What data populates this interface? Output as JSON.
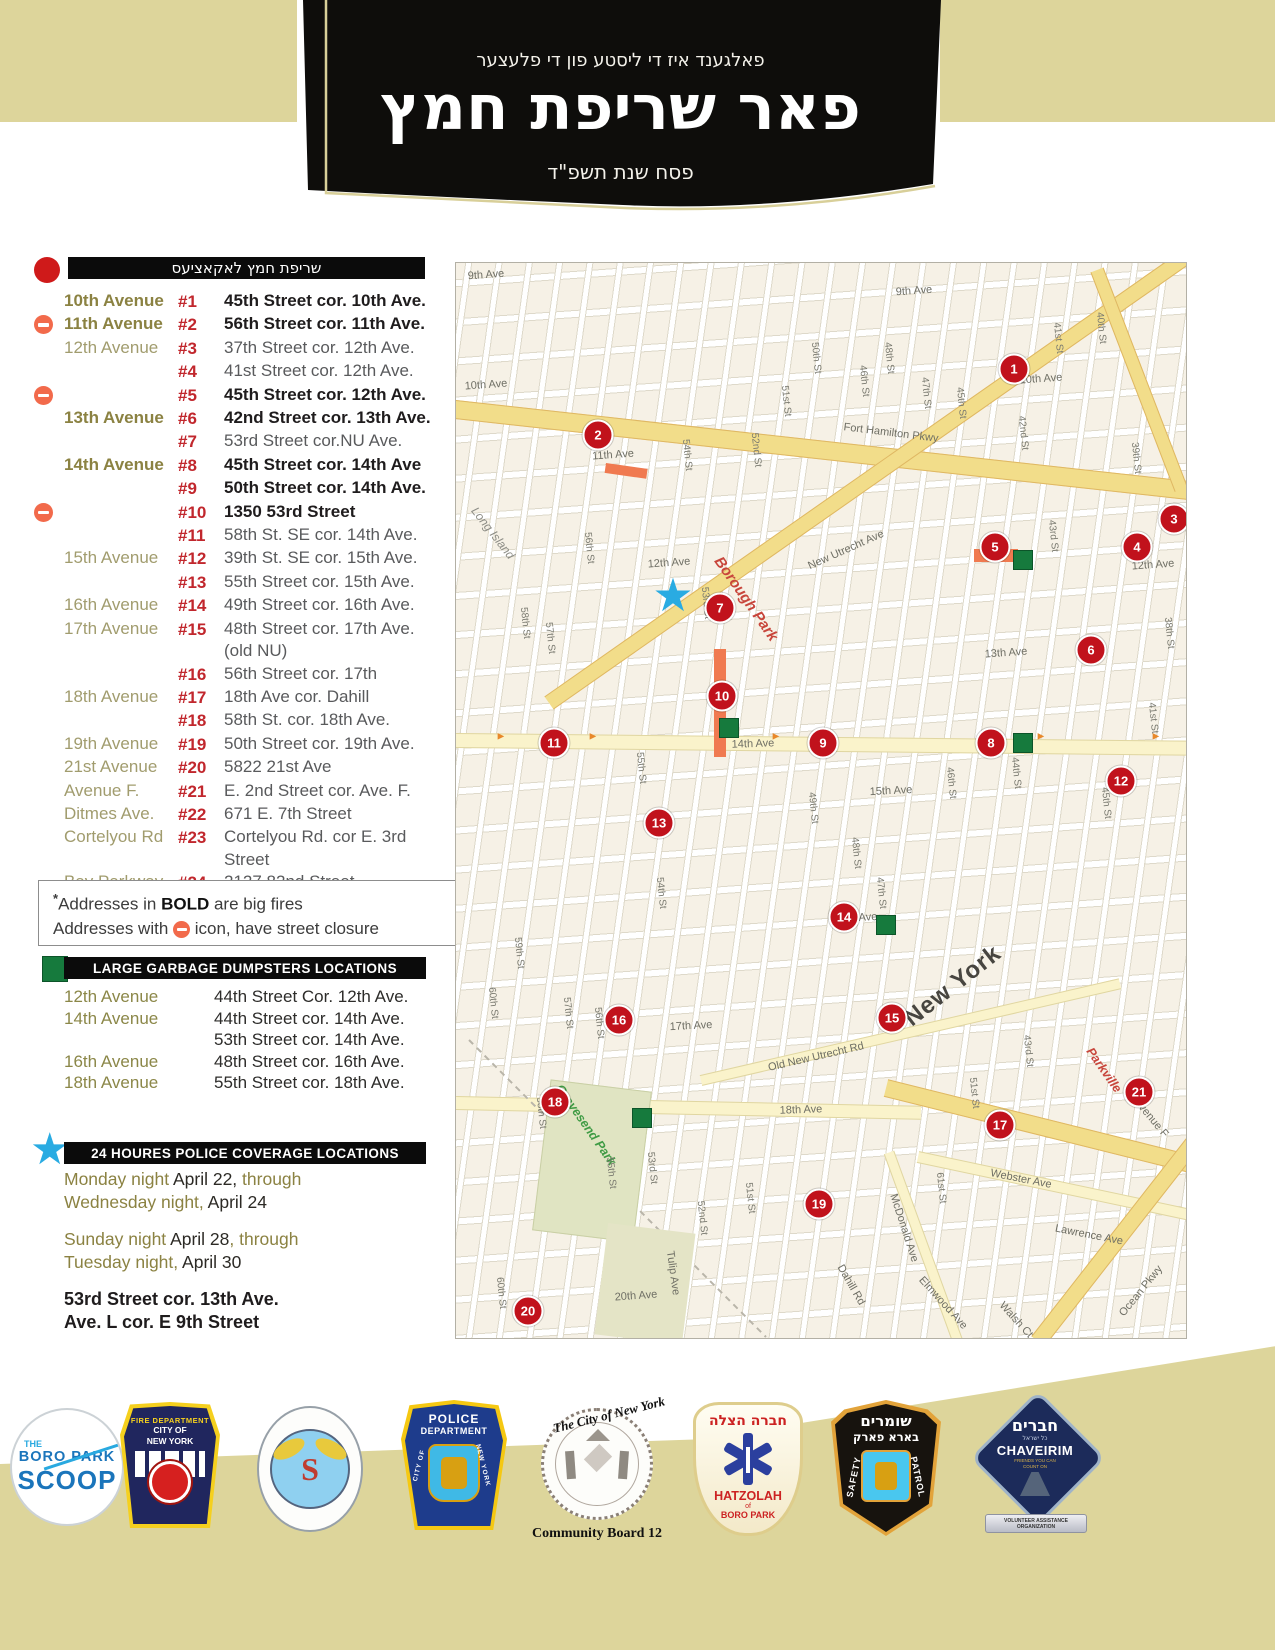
{
  "header": {
    "line1": "פאלגענד איז די ליסטע פון די פלעצער",
    "title": "פאר שריפת חמץ",
    "line3": "פסח שנת תשפ\"ד"
  },
  "burn_section": {
    "heading": "שריפת חמץ לאקאציעס",
    "rows": [
      {
        "avenue": "10th Avenue",
        "avenue_bold": true,
        "num": "#1",
        "address": "45th Street cor. 10th Ave.",
        "bold": true,
        "closure": false
      },
      {
        "avenue": "11th Avenue",
        "avenue_bold": true,
        "num": "#2",
        "address": "56th Street cor. 11th Ave.",
        "bold": true,
        "closure": true
      },
      {
        "avenue": "12th Avenue",
        "avenue_bold": false,
        "num": "#3",
        "address": "37th Street cor. 12th Ave.",
        "bold": false,
        "closure": false
      },
      {
        "avenue": "",
        "avenue_bold": false,
        "num": "#4",
        "address": "41st Street cor. 12th Ave.",
        "bold": false,
        "closure": false
      },
      {
        "avenue": "",
        "avenue_bold": false,
        "num": "#5",
        "address": "45th Street cor. 12th Ave.",
        "bold": true,
        "closure": true
      },
      {
        "avenue": "13th Avenue",
        "avenue_bold": true,
        "num": "#6",
        "address": "42nd Street cor. 13th Ave.",
        "bold": true,
        "closure": false
      },
      {
        "avenue": "",
        "avenue_bold": false,
        "num": "#7",
        "address": "53rd Street cor.NU Ave.",
        "bold": false,
        "closure": false
      },
      {
        "avenue": "14th Avenue",
        "avenue_bold": true,
        "num": "#8",
        "address": "45th Street cor. 14th Ave",
        "bold": true,
        "closure": false
      },
      {
        "avenue": "",
        "avenue_bold": false,
        "num": "#9",
        "address": "50th Street cor. 14th Ave.",
        "bold": true,
        "closure": false
      },
      {
        "avenue": "",
        "avenue_bold": false,
        "num": "#10",
        "address": "1350 53rd Street",
        "bold": true,
        "closure": true
      },
      {
        "avenue": "",
        "avenue_bold": false,
        "num": "#11",
        "address": "58th St. SE cor. 14th Ave.",
        "bold": false,
        "closure": false
      },
      {
        "avenue": "15th Avenue",
        "avenue_bold": false,
        "num": "#12",
        "address": "39th St. SE cor. 15th Ave.",
        "bold": false,
        "closure": false
      },
      {
        "avenue": "",
        "avenue_bold": false,
        "num": "#13",
        "address": "55th Street cor. 15th Ave.",
        "bold": false,
        "closure": false
      },
      {
        "avenue": "16th Avenue",
        "avenue_bold": false,
        "num": "#14",
        "address": "49th Street cor. 16th Ave.",
        "bold": false,
        "closure": false
      },
      {
        "avenue": "17th Avenue",
        "avenue_bold": false,
        "num": "#15",
        "address": "48th Street cor. 17th Ave. (old NU)",
        "bold": false,
        "closure": false
      },
      {
        "avenue": "",
        "avenue_bold": false,
        "num": "#16",
        "address": "56th Street cor. 17th",
        "bold": false,
        "closure": false
      },
      {
        "avenue": "18th Avenue",
        "avenue_bold": false,
        "num": "#17",
        "address": "18th Ave cor. Dahill",
        "bold": false,
        "closure": false
      },
      {
        "avenue": "",
        "avenue_bold": false,
        "num": "#18",
        "address": "58th St. cor. 18th Ave.",
        "bold": false,
        "closure": false
      },
      {
        "avenue": "19th Avenue",
        "avenue_bold": false,
        "num": "#19",
        "address": "50th Street cor. 19th Ave.",
        "bold": false,
        "closure": false
      },
      {
        "avenue": "21st Avenue",
        "avenue_bold": false,
        "num": "#20",
        "address": "5822 21st Ave",
        "bold": false,
        "closure": false
      },
      {
        "avenue": "Avenue F.",
        "avenue_bold": false,
        "num": "#21",
        "address": "E. 2nd Street cor. Ave. F.",
        "bold": false,
        "closure": false
      },
      {
        "avenue": "Ditmes Ave.",
        "avenue_bold": false,
        "num": "#22",
        "address": "671 E. 7th Street",
        "bold": false,
        "closure": false
      },
      {
        "avenue": "Cortelyou Rd",
        "avenue_bold": false,
        "num": "#23",
        "address": "Cortelyou Rd. cor E. 3rd Street",
        "bold": false,
        "closure": false
      },
      {
        "avenue": "Bay Parkway",
        "avenue_bold": false,
        "num": "#24",
        "address": "2127 82nd Street",
        "bold": false,
        "closure": false
      }
    ],
    "note_ast": "*",
    "note1_pre": "Addresses in ",
    "note1_bold": "BOLD",
    "note1_post": " are big fires",
    "note2_pre": "Addresses with",
    "note2_post": " icon, have street closure"
  },
  "dumpster_section": {
    "heading": "LARGE GARBAGE DUMPSTERS LOCATIONS",
    "rows": [
      {
        "avenue": "12th Avenue",
        "address": "44th Street Cor. 12th Ave."
      },
      {
        "avenue": "14th Avenue",
        "address": "44th Street cor. 14th Ave."
      },
      {
        "avenue": "",
        "address": "53th Street cor. 14th Ave."
      },
      {
        "avenue": "16th Avenue",
        "address": "48th Street cor. 16th Ave."
      },
      {
        "avenue": "18th Avenue",
        "address": "55th Street cor. 18th Ave."
      }
    ]
  },
  "police_section": {
    "heading": "24 HOURES POLICE COVERAGE LOCATIONS",
    "paragraphs": [
      [
        [
          {
            "t": "Monday night ",
            "dark": false
          },
          {
            "t": "April 22,",
            "dark": true
          },
          {
            "t": " through",
            "dark": false
          }
        ],
        [
          {
            "t": "Wednesday night,",
            "dark": false
          },
          {
            "t": " April 24",
            "dark": true
          }
        ]
      ],
      [
        [
          {
            "t": "Sunday night ",
            "dark": false
          },
          {
            "t": "April 28",
            "dark": true
          },
          {
            "t": ", through",
            "dark": false
          }
        ],
        [
          {
            "t": "Tuesday night,",
            "dark": false
          },
          {
            "t": " April 30",
            "dark": true
          }
        ]
      ]
    ],
    "footer_lines": [
      "53rd Street cor. 13th Ave.",
      "Ave. L cor. E 9th Street"
    ]
  },
  "map": {
    "markers": [
      {
        "n": "1",
        "x": 558,
        "y": 106
      },
      {
        "n": "2",
        "x": 142,
        "y": 172
      },
      {
        "n": "3",
        "x": 718,
        "y": 256
      },
      {
        "n": "4",
        "x": 681,
        "y": 284
      },
      {
        "n": "5",
        "x": 539,
        "y": 284
      },
      {
        "n": "6",
        "x": 635,
        "y": 387
      },
      {
        "n": "7",
        "x": 264,
        "y": 345
      },
      {
        "n": "8",
        "x": 535,
        "y": 480
      },
      {
        "n": "9",
        "x": 367,
        "y": 480
      },
      {
        "n": "10",
        "x": 266,
        "y": 433
      },
      {
        "n": "11",
        "x": 98,
        "y": 480
      },
      {
        "n": "12",
        "x": 665,
        "y": 518
      },
      {
        "n": "13",
        "x": 203,
        "y": 560
      },
      {
        "n": "14",
        "x": 388,
        "y": 654
      },
      {
        "n": "15",
        "x": 436,
        "y": 755
      },
      {
        "n": "16",
        "x": 163,
        "y": 757
      },
      {
        "n": "17",
        "x": 544,
        "y": 862
      },
      {
        "n": "18",
        "x": 99,
        "y": 839
      },
      {
        "n": "19",
        "x": 363,
        "y": 941
      },
      {
        "n": "20",
        "x": 72,
        "y": 1048
      },
      {
        "n": "21",
        "x": 683,
        "y": 829
      }
    ],
    "dumpsters": [
      {
        "x": 567,
        "y": 297
      },
      {
        "x": 273,
        "y": 465
      },
      {
        "x": 567,
        "y": 480
      },
      {
        "x": 430,
        "y": 662
      },
      {
        "x": 186,
        "y": 855
      }
    ],
    "closures": [
      {
        "x": 150,
        "y": 200,
        "w": 42,
        "h": 10,
        "r": 8
      },
      {
        "x": 518,
        "y": 286,
        "w": 44,
        "h": 13,
        "r": 0
      },
      {
        "x": 258,
        "y": 386,
        "w": 12,
        "h": 108,
        "r": 0
      }
    ],
    "arrows": [
      {
        "x": 45,
        "y": 474
      },
      {
        "x": 137,
        "y": 474
      },
      {
        "x": 320,
        "y": 474
      },
      {
        "x": 585,
        "y": 474
      },
      {
        "x": 700,
        "y": 474
      }
    ],
    "star": {
      "x": 217,
      "y": 332
    },
    "labels": [
      {
        "t": "9th Ave",
        "x": 30,
        "y": 12,
        "r": -4,
        "c": "ave"
      },
      {
        "t": "9th Ave",
        "x": 458,
        "y": 28,
        "r": -4,
        "c": "ave"
      },
      {
        "t": "10th Ave",
        "x": 30,
        "y": 122,
        "r": -4,
        "c": "ave"
      },
      {
        "t": "10th Ave",
        "x": 585,
        "y": 116,
        "r": -4,
        "c": "ave"
      },
      {
        "t": "11th Ave",
        "x": 157,
        "y": 192,
        "r": -4,
        "c": "ave"
      },
      {
        "t": "12th Ave",
        "x": 213,
        "y": 300,
        "r": -4,
        "c": "ave"
      },
      {
        "t": "12th Ave",
        "x": 697,
        "y": 302,
        "r": -4,
        "c": "ave"
      },
      {
        "t": "13th Ave",
        "x": 550,
        "y": 390,
        "r": -4,
        "c": "ave"
      },
      {
        "t": "14th Ave",
        "x": 297,
        "y": 481,
        "r": -2,
        "c": "ave"
      },
      {
        "t": "15th Ave",
        "x": 435,
        "y": 528,
        "r": -3,
        "c": "ave"
      },
      {
        "t": "16th Ave",
        "x": 400,
        "y": 655,
        "r": -3,
        "c": "ave"
      },
      {
        "t": "17th Ave",
        "x": 235,
        "y": 763,
        "r": -3,
        "c": "ave"
      },
      {
        "t": "18th Ave",
        "x": 345,
        "y": 847,
        "r": -2,
        "c": "ave"
      },
      {
        "t": "20th Ave",
        "x": 180,
        "y": 1033,
        "r": -4,
        "c": "ave"
      },
      {
        "t": "Fort Hamilton Pkwy",
        "x": 435,
        "y": 170,
        "r": 7,
        "c": "ave"
      },
      {
        "t": "New Utrecht Ave",
        "x": 390,
        "y": 287,
        "r": -24,
        "c": "ave"
      },
      {
        "t": "Old New Utrecht Rd",
        "x": 360,
        "y": 794,
        "r": -13,
        "c": "ave"
      },
      {
        "t": "Webster Ave",
        "x": 565,
        "y": 916,
        "r": 11,
        "c": "ave"
      },
      {
        "t": "Lawrence Ave",
        "x": 633,
        "y": 972,
        "r": 11,
        "c": "ave"
      },
      {
        "t": "McDonald Ave",
        "x": 448,
        "y": 965,
        "r": 72,
        "c": "ave"
      },
      {
        "t": "Ocean Pkwy",
        "x": 685,
        "y": 1028,
        "r": -51,
        "c": "ave"
      },
      {
        "t": "Avenue F",
        "x": 695,
        "y": 855,
        "r": 50,
        "c": "ave"
      },
      {
        "t": "Elmwood Ave",
        "x": 487,
        "y": 1040,
        "r": 48,
        "c": "ave"
      },
      {
        "t": "Walsh Ct",
        "x": 560,
        "y": 1057,
        "r": 48,
        "c": "ave"
      },
      {
        "t": "Tulip Ave",
        "x": 217,
        "y": 1010,
        "r": 82,
        "c": "ave"
      },
      {
        "t": "Dahill Rd",
        "x": 395,
        "y": 1022,
        "r": 60,
        "c": "ave"
      },
      {
        "t": "Borough Park",
        "x": 290,
        "y": 336,
        "r": 55,
        "c": "red"
      },
      {
        "t": "Parkville",
        "x": 648,
        "y": 807,
        "r": 55,
        "c": "red2"
      },
      {
        "t": "New York",
        "x": 497,
        "y": 723,
        "r": -38,
        "c": "big"
      },
      {
        "t": "Gravesend Park",
        "x": 130,
        "y": 862,
        "r": 55,
        "c": "green"
      },
      {
        "t": "Long Island",
        "x": 37,
        "y": 270,
        "r": 52,
        "c": "island"
      },
      {
        "t": "60th St",
        "x": 37,
        "y": 740,
        "r": 84,
        "c": "st"
      },
      {
        "t": "60th St",
        "x": 45,
        "y": 1030,
        "r": 84,
        "c": "st"
      },
      {
        "t": "59th St",
        "x": 63,
        "y": 690,
        "r": 84,
        "c": "st"
      },
      {
        "t": "58th St",
        "x": 69,
        "y": 360,
        "r": 84,
        "c": "st"
      },
      {
        "t": "58th St",
        "x": 85,
        "y": 850,
        "r": 84,
        "c": "st"
      },
      {
        "t": "57th St",
        "x": 94,
        "y": 375,
        "r": 84,
        "c": "st"
      },
      {
        "t": "57th St",
        "x": 112,
        "y": 750,
        "r": 84,
        "c": "st"
      },
      {
        "t": "56th St",
        "x": 133,
        "y": 285,
        "r": 84,
        "c": "st"
      },
      {
        "t": "56th St",
        "x": 143,
        "y": 760,
        "r": 84,
        "c": "st"
      },
      {
        "t": "55th St",
        "x": 185,
        "y": 505,
        "r": 84,
        "c": "st"
      },
      {
        "t": "55th St",
        "x": 155,
        "y": 910,
        "r": 84,
        "c": "st"
      },
      {
        "t": "54th St",
        "x": 231,
        "y": 192,
        "r": 84,
        "c": "st"
      },
      {
        "t": "54th St",
        "x": 205,
        "y": 630,
        "r": 84,
        "c": "st"
      },
      {
        "t": "53rd St",
        "x": 250,
        "y": 340,
        "r": 84,
        "c": "st"
      },
      {
        "t": "53rd St",
        "x": 196,
        "y": 905,
        "r": 84,
        "c": "st"
      },
      {
        "t": "52nd St",
        "x": 300,
        "y": 187,
        "r": 84,
        "c": "st"
      },
      {
        "t": "52nd St",
        "x": 246,
        "y": 955,
        "r": 84,
        "c": "st"
      },
      {
        "t": "51st St",
        "x": 330,
        "y": 138,
        "r": 84,
        "c": "st"
      },
      {
        "t": "51st St",
        "x": 294,
        "y": 935,
        "r": 84,
        "c": "st"
      },
      {
        "t": "51st St",
        "x": 518,
        "y": 830,
        "r": 84,
        "c": "st"
      },
      {
        "t": "50th St",
        "x": 360,
        "y": 95,
        "r": 84,
        "c": "st"
      },
      {
        "t": "49th St",
        "x": 357,
        "y": 545,
        "r": 84,
        "c": "st"
      },
      {
        "t": "48th St",
        "x": 433,
        "y": 95,
        "r": 84,
        "c": "st"
      },
      {
        "t": "48th St",
        "x": 400,
        "y": 590,
        "r": 84,
        "c": "st"
      },
      {
        "t": "47th St",
        "x": 470,
        "y": 130,
        "r": 84,
        "c": "st"
      },
      {
        "t": "47th St",
        "x": 425,
        "y": 630,
        "r": 84,
        "c": "st"
      },
      {
        "t": "46th St",
        "x": 408,
        "y": 118,
        "r": 84,
        "c": "st"
      },
      {
        "t": "46th St",
        "x": 495,
        "y": 520,
        "r": 84,
        "c": "st"
      },
      {
        "t": "45th St",
        "x": 505,
        "y": 140,
        "r": 84,
        "c": "st"
      },
      {
        "t": "45th St",
        "x": 650,
        "y": 540,
        "r": 84,
        "c": "st"
      },
      {
        "t": "44th St",
        "x": 560,
        "y": 510,
        "r": 84,
        "c": "st"
      },
      {
        "t": "43rd St",
        "x": 597,
        "y": 273,
        "r": 84,
        "c": "st"
      },
      {
        "t": "43rd St",
        "x": 572,
        "y": 788,
        "r": 84,
        "c": "st"
      },
      {
        "t": "42nd St",
        "x": 567,
        "y": 170,
        "r": 84,
        "c": "st"
      },
      {
        "t": "41st St",
        "x": 602,
        "y": 75,
        "r": 84,
        "c": "st"
      },
      {
        "t": "41st St",
        "x": 697,
        "y": 455,
        "r": 84,
        "c": "st"
      },
      {
        "t": "40th St",
        "x": 645,
        "y": 65,
        "r": 84,
        "c": "st"
      },
      {
        "t": "39th St",
        "x": 680,
        "y": 195,
        "r": 84,
        "c": "st"
      },
      {
        "t": "38th St",
        "x": 713,
        "y": 370,
        "r": 84,
        "c": "st"
      },
      {
        "t": "61st St",
        "x": 485,
        "y": 925,
        "r": 84,
        "c": "st"
      }
    ]
  },
  "logos": [
    {
      "name": "The Boro Park Scoop",
      "the": "THE",
      "line1": "BORO PARK",
      "line2": "SCOOP"
    },
    {
      "name": "Fire Department City of New York",
      "arc": "FIRE DEPARTMENT",
      "line1": "CITY OF",
      "line2": "NEW YORK"
    },
    {
      "name": "Department of Sanitation New York",
      "initial": "S"
    },
    {
      "name": "Police Department City of New York",
      "line1": "POLICE",
      "line2": "DEPARTMENT",
      "left": "CITY OF",
      "right": "NEW YORK"
    },
    {
      "name": "The City of New York",
      "arc": "The City of New York",
      "caption": "Community Board 12"
    },
    {
      "name": "Hatzolah of Boro Park",
      "hebrew": "חברה הצלה",
      "line1": "HATZOLAH",
      "of": "of",
      "line2": "BORO PARK"
    },
    {
      "name": "Shomrim Boro Park Safety Patrol",
      "hebrew1": "שומרים",
      "hebrew2": "בארא פארק",
      "left": "SAFETY",
      "right": "PATROL"
    },
    {
      "name": "Chaveirim",
      "hebrew": "חברים",
      "sub": "כל ישראל",
      "title": "CHAVEIRIM",
      "tag1": "FRIENDS YOU CAN",
      "tag2": "COUNT ON",
      "ribbon": "VOLUNTEER ASSISTANCE ORGANIZATION"
    }
  ]
}
